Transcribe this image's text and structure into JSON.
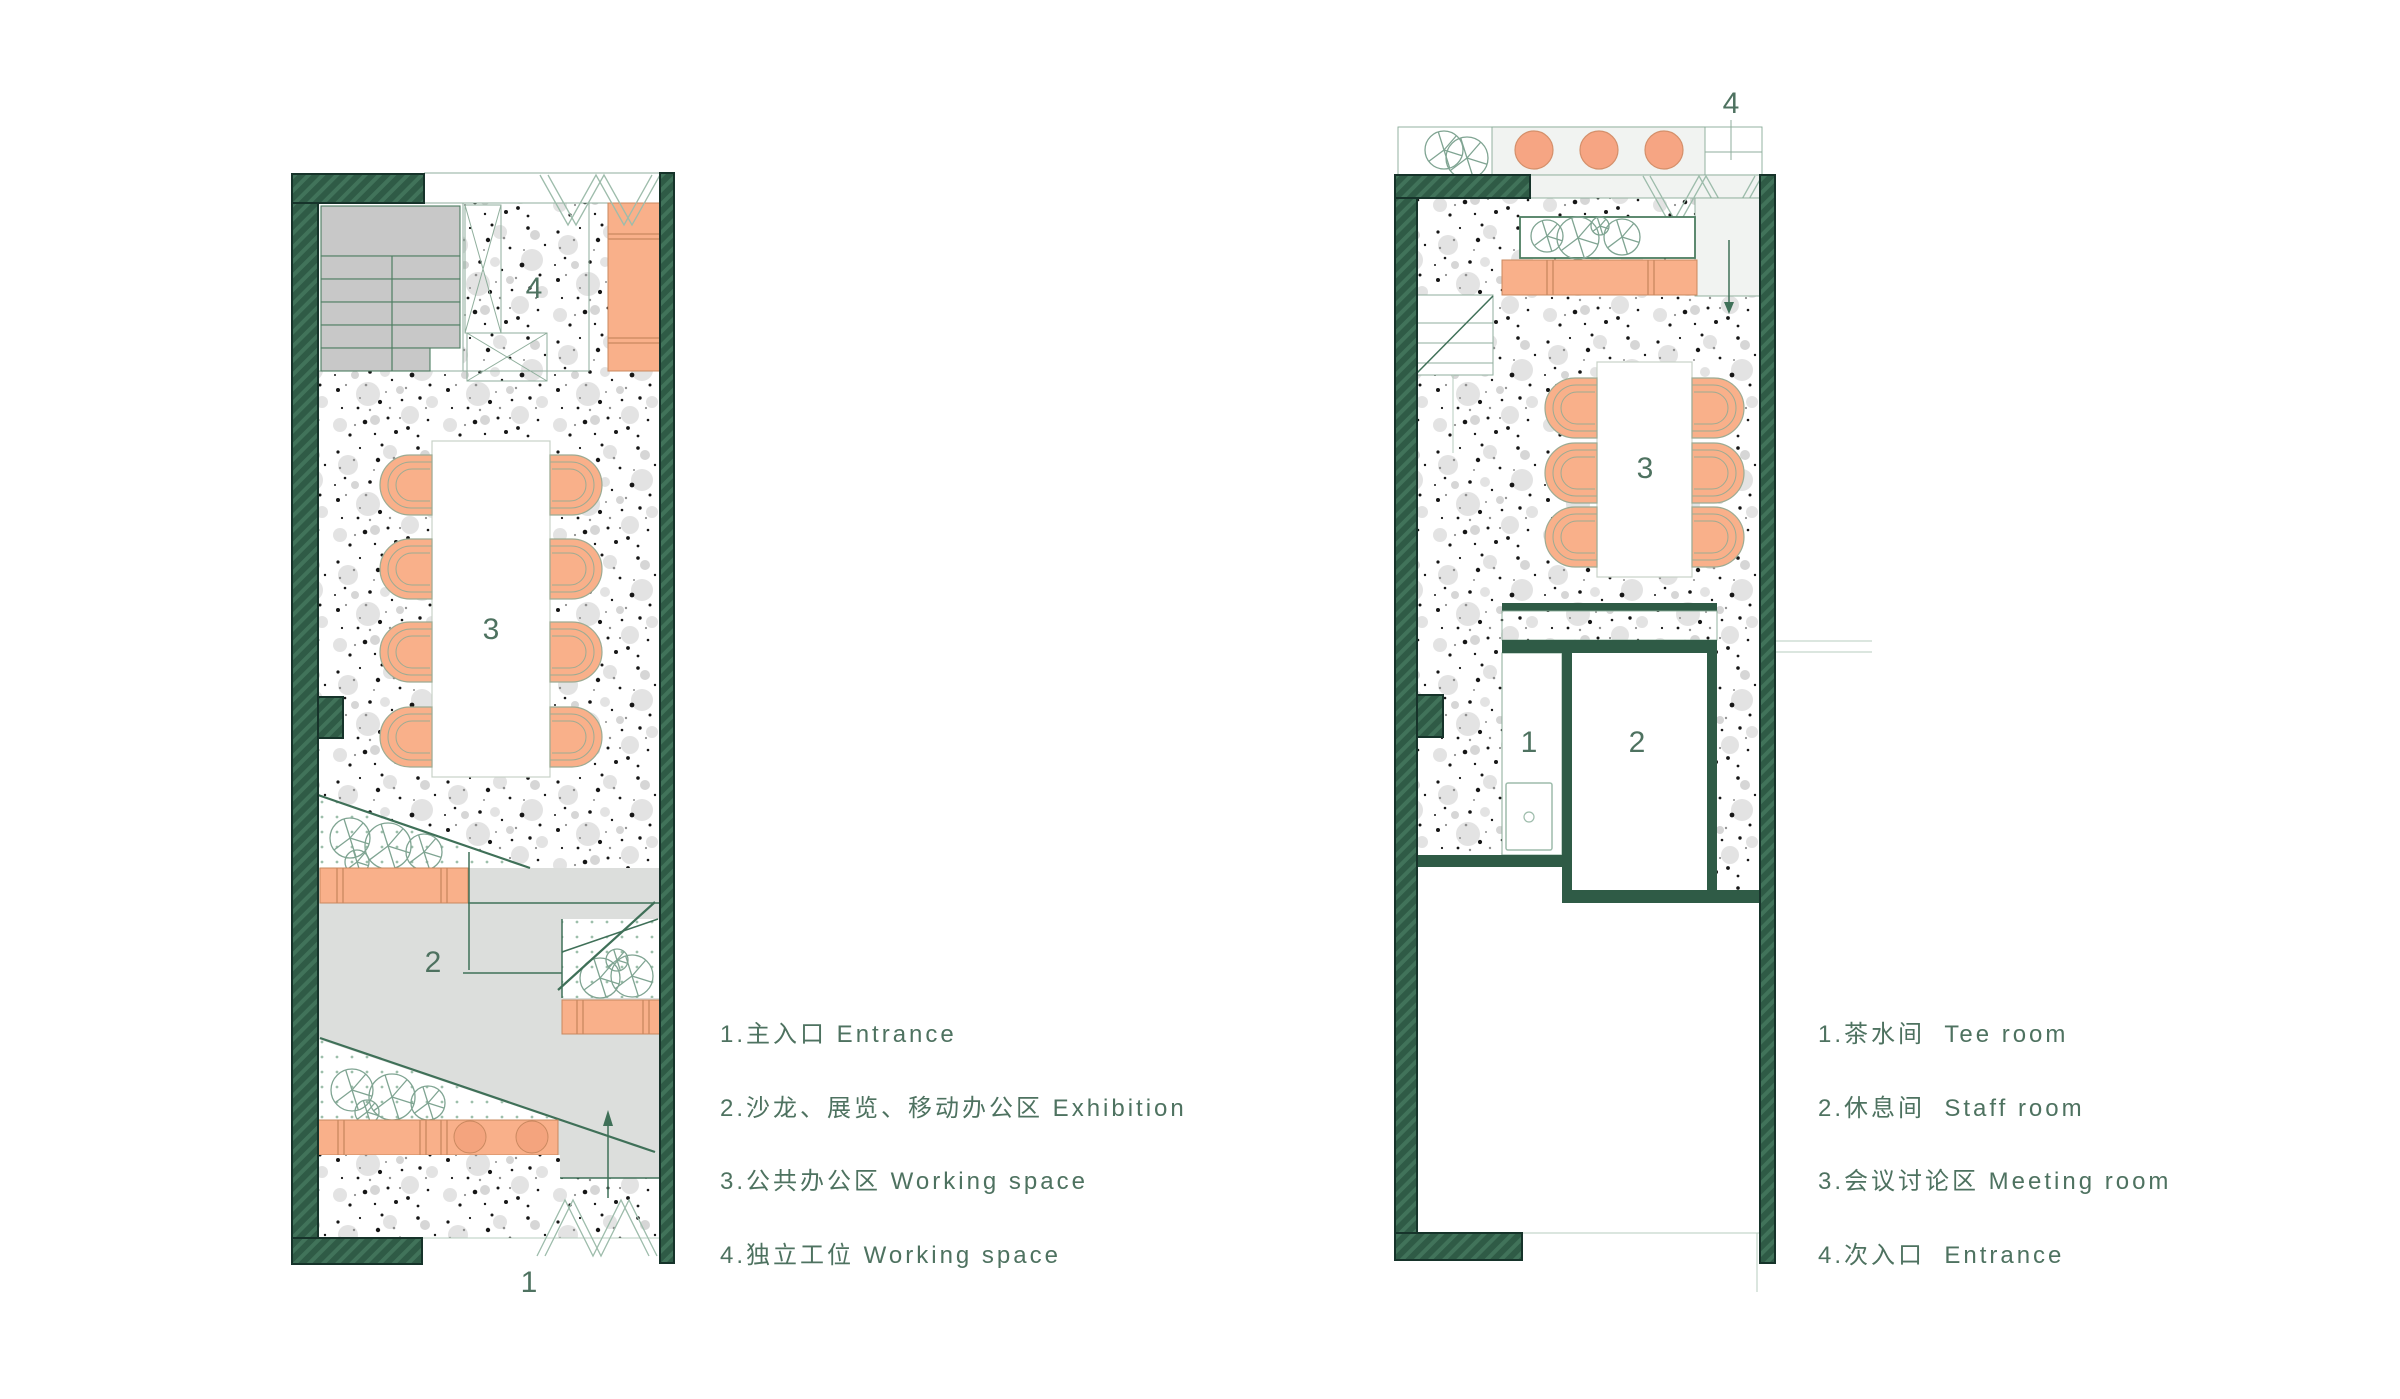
{
  "colors": {
    "wall_green": "#2f5b46",
    "wall_hatch": "#447759",
    "wall_outline": "#16332a",
    "accent_orange": "#f9b08a",
    "orange_line": "#c9885f",
    "exhibition_gray": "#dcdedc",
    "stair_gray": "#c8c8c8",
    "light_panel": "#f1f3f1",
    "line_green": "#3f7058",
    "text_green": "#4e7260"
  },
  "left_plan": {
    "area_labels": {
      "entrance": "1",
      "exhibition": "2",
      "working_space": "3",
      "workstation": "4"
    }
  },
  "right_plan": {
    "area_labels": {
      "tea_room": "1",
      "staff_room": "2",
      "meeting_room": "3",
      "entrance": "4"
    }
  },
  "left_legend": {
    "items": [
      {
        "text": "1.主入口 Entrance"
      },
      {
        "text": "2.沙龙、展览、移动办公区 Exhibition"
      },
      {
        "text": "3.公共办公区 Working space"
      },
      {
        "text": "4.独立工位 Working space"
      }
    ]
  },
  "right_legend": {
    "items": [
      {
        "text": "1.茶水间  Tee room"
      },
      {
        "text": "2.休息间  Staff room"
      },
      {
        "text": "3.会议讨论区 Meeting room"
      },
      {
        "text": "4.次入口  Entrance"
      }
    ]
  }
}
